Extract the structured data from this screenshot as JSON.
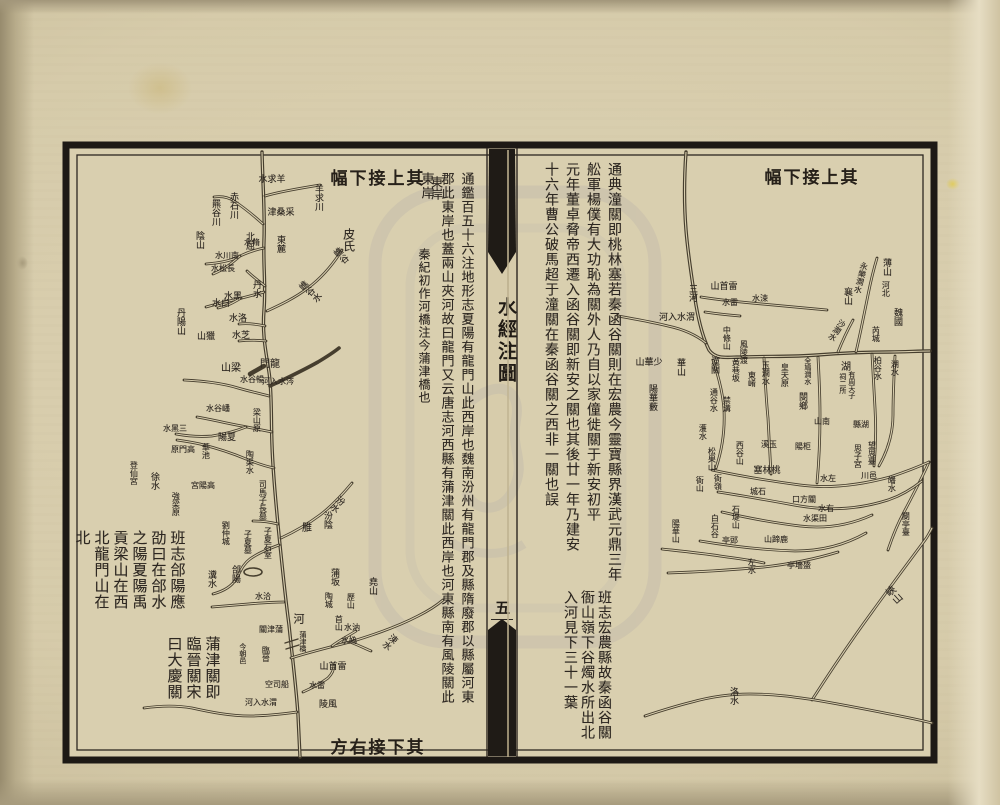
{
  "document": {
    "type": "woodblock-printed river map leaf (two-page spread)",
    "title": "水經注圖",
    "leaf_number": "五",
    "ink_color": "#2d2721",
    "paper_color": "#d9cfaf",
    "border_color": "#1d1915"
  },
  "left_map": {
    "banner_top": "其上接下幅",
    "banner_bottom": "其下接右方",
    "notes": [
      {
        "x": 466,
        "y": 172,
        "fs": 13,
        "gap": 20,
        "columns": [
          "通鑑百五十六注地形志夏陽有龍門山此西岸也魏南汾州有龍門郡及縣隋廢郡以縣屬河東",
          "郡此東岸也蓋兩山夾河故曰龍門又云唐志河西縣有蒲津關此西岸也河東縣南有風陵關此",
          "東岸"
        ]
      },
      {
        "x": 424,
        "y": 248,
        "fs": 12,
        "gap": 18,
        "columns": [
          "秦紀初作河橋注今蒲津橋也"
        ]
      },
      {
        "x": 177,
        "y": 530,
        "fs": 15,
        "gap": 19,
        "columns": [
          "班志郃陽應",
          "劭曰在郃水",
          "之陽夏陽禹",
          "貢梁山在西",
          "北龍門山在",
          "北"
        ]
      },
      {
        "x": 212,
        "y": 636,
        "fs": 15,
        "gap": 19,
        "columns": [
          "蒲津關即",
          "臨晉關宋",
          "曰大慶關"
        ]
      }
    ],
    "labels": [
      {
        "t": "羊求川",
        "x": 318,
        "y": 184,
        "o": "v",
        "s": 9
      },
      {
        "t": "羊求水",
        "x": 272,
        "y": 180,
        "o": "hr",
        "s": 9
      },
      {
        "t": "采桑津",
        "x": 281,
        "y": 213,
        "o": "hr",
        "s": 9
      },
      {
        "t": "赤石川",
        "x": 233,
        "y": 192,
        "o": "v",
        "s": 9
      },
      {
        "t": "羆谷川",
        "x": 215,
        "y": 199,
        "o": "v",
        "s": 9
      },
      {
        "t": "陰山",
        "x": 199,
        "y": 231,
        "o": "v",
        "s": 9
      },
      {
        "t": "東麓",
        "x": 280,
        "y": 235,
        "o": "v",
        "s": 9
      },
      {
        "t": "北屈",
        "x": 249,
        "y": 232,
        "o": "v",
        "s": 9
      },
      {
        "t": "脩水",
        "x": 252,
        "y": 243,
        "o": "hr",
        "s": 8
      },
      {
        "t": "南川水",
        "x": 227,
        "y": 256,
        "o": "hr",
        "s": 8
      },
      {
        "t": "長松水",
        "x": 223,
        "y": 269,
        "o": "hr",
        "s": 8
      },
      {
        "t": "丹水",
        "x": 256,
        "y": 280,
        "o": "v",
        "s": 9
      },
      {
        "t": "皮氏",
        "x": 349,
        "y": 228,
        "o": "v",
        "s": 12
      },
      {
        "t": "嶕谷",
        "x": 334,
        "y": 250,
        "o": "v",
        "s": 9,
        "r": -40
      },
      {
        "t": "嶕谷水",
        "x": 299,
        "y": 284,
        "o": "v",
        "s": 9,
        "r": -48
      },
      {
        "t": "黑水",
        "x": 233,
        "y": 297,
        "o": "hr",
        "s": 9
      },
      {
        "t": "白水",
        "x": 221,
        "y": 304,
        "o": "hr",
        "s": 9
      },
      {
        "t": "洛水",
        "x": 238,
        "y": 319,
        "o": "hr",
        "s": 9
      },
      {
        "t": "芝水",
        "x": 241,
        "y": 336,
        "o": "hr",
        "s": 9
      },
      {
        "t": "丹陽山",
        "x": 180,
        "y": 308,
        "o": "v",
        "s": 9
      },
      {
        "t": "獵山",
        "x": 206,
        "y": 337,
        "o": "hr",
        "s": 9
      },
      {
        "t": "梁山",
        "x": 231,
        "y": 369,
        "o": "hr",
        "s": 10
      },
      {
        "t": "龍門",
        "x": 270,
        "y": 365,
        "o": "hr",
        "s": 10
      },
      {
        "t": "涔水入河",
        "x": 278,
        "y": 382,
        "o": "hr",
        "s": 8
      },
      {
        "t": "暢谷水",
        "x": 252,
        "y": 380,
        "o": "hr",
        "s": 8
      },
      {
        "t": "梁山原",
        "x": 257,
        "y": 408,
        "o": "v",
        "s": 8
      },
      {
        "t": "嶓谷水",
        "x": 218,
        "y": 409,
        "o": "hr",
        "s": 8
      },
      {
        "t": "三黑水",
        "x": 175,
        "y": 429,
        "o": "hr",
        "s": 8
      },
      {
        "t": "夏陽",
        "x": 227,
        "y": 438,
        "o": "hr",
        "s": 9
      },
      {
        "t": "華池",
        "x": 206,
        "y": 443,
        "o": "v",
        "s": 8
      },
      {
        "t": "高門原",
        "x": 183,
        "y": 450,
        "o": "hr",
        "s": 8
      },
      {
        "t": "陶渠水",
        "x": 250,
        "y": 450,
        "o": "v",
        "s": 8
      },
      {
        "t": "司馬子長墓",
        "x": 263,
        "y": 480,
        "o": "v",
        "s": 8
      },
      {
        "t": "高陽宮",
        "x": 203,
        "y": 486,
        "o": "hr",
        "s": 8
      },
      {
        "t": "強梁原",
        "x": 176,
        "y": 492,
        "o": "v",
        "s": 8
      },
      {
        "t": "徐水",
        "x": 154,
        "y": 472,
        "o": "v",
        "s": 9
      },
      {
        "t": "登仙宮",
        "x": 134,
        "y": 461,
        "o": "v",
        "s": 8
      },
      {
        "t": "劉仲城",
        "x": 226,
        "y": 521,
        "o": "v",
        "s": 8
      },
      {
        "t": "子夏墓",
        "x": 248,
        "y": 530,
        "o": "v",
        "s": 8
      },
      {
        "t": "子夏石室",
        "x": 268,
        "y": 527,
        "o": "v",
        "s": 8
      },
      {
        "t": "汾水",
        "x": 342,
        "y": 496,
        "o": "v",
        "s": 9,
        "r": 38
      },
      {
        "t": "汾陰",
        "x": 327,
        "y": 511,
        "o": "v",
        "s": 9
      },
      {
        "t": "脽",
        "x": 305,
        "y": 522,
        "o": "v",
        "s": 10
      },
      {
        "t": "郃陽",
        "x": 235,
        "y": 565,
        "o": "v",
        "s": 9
      },
      {
        "t": "瀵水",
        "x": 211,
        "y": 570,
        "o": "v",
        "s": 9
      },
      {
        "t": "洽水",
        "x": 263,
        "y": 597,
        "o": "hr",
        "s": 8
      },
      {
        "t": "河",
        "x": 299,
        "y": 613,
        "o": "v",
        "s": 11
      },
      {
        "t": "蒲津關",
        "x": 271,
        "y": 630,
        "o": "hr",
        "s": 8
      },
      {
        "t": "今朝邑",
        "x": 243,
        "y": 643,
        "o": "v",
        "s": 7
      },
      {
        "t": "臨晉",
        "x": 266,
        "y": 646,
        "o": "v",
        "s": 8
      },
      {
        "t": "蒲津橋",
        "x": 303,
        "y": 631,
        "o": "v",
        "s": 7
      },
      {
        "t": "蒲坂",
        "x": 334,
        "y": 568,
        "o": "v",
        "s": 9
      },
      {
        "t": "堯山",
        "x": 372,
        "y": 577,
        "o": "v",
        "s": 9
      },
      {
        "t": "陶城",
        "x": 329,
        "y": 592,
        "o": "v",
        "s": 8
      },
      {
        "t": "歷山",
        "x": 351,
        "y": 593,
        "o": "v",
        "s": 8
      },
      {
        "t": "首山",
        "x": 339,
        "y": 615,
        "o": "v",
        "s": 8
      },
      {
        "t": "汭水",
        "x": 352,
        "y": 628,
        "o": "hr",
        "s": 8
      },
      {
        "t": "媯水",
        "x": 349,
        "y": 641,
        "o": "hr",
        "s": 8
      },
      {
        "t": "涑水",
        "x": 395,
        "y": 634,
        "o": "v",
        "s": 9,
        "r": 42
      },
      {
        "t": "雷首山",
        "x": 333,
        "y": 667,
        "o": "hr",
        "s": 9
      },
      {
        "t": "雷水",
        "x": 317,
        "y": 686,
        "o": "hr",
        "s": 8
      },
      {
        "t": "風陵",
        "x": 328,
        "y": 705,
        "o": "hr",
        "s": 9
      },
      {
        "t": "船司空",
        "x": 277,
        "y": 685,
        "o": "hr",
        "s": 8
      },
      {
        "t": "渭水入河",
        "x": 261,
        "y": 703,
        "o": "hr",
        "s": 8
      },
      {
        "t": "東岸",
        "x": 437,
        "y": 176,
        "o": "v",
        "s": 12
      }
    ]
  },
  "right_map": {
    "banner_top": "其上接下幅",
    "notes": [
      {
        "x": 614,
        "y": 162,
        "fs": 14,
        "gap": 21,
        "columns": [
          "通典潼關即桃林塞若秦函谷關則在宏農今靈寶縣界漢武元鼎三年",
          "舩軍楊僕有大功恥為關外人乃自以家僮徙關于新安初平",
          "元年董卓脅帝西遷入函谷關即新安之關也其後廿一年乃建安",
          "十六年曹公破馬超于潼關在秦函谷關之西非一關也誤"
        ]
      },
      {
        "x": 604,
        "y": 590,
        "fs": 14,
        "gap": 17,
        "columns": [
          "班志宏農縣故秦函谷關",
          "衙山嶺下谷燭水所出北",
          "入河見下三十一葉"
        ]
      }
    ],
    "labels": [
      {
        "t": "三河",
        "x": 692,
        "y": 284,
        "o": "v",
        "s": 9
      },
      {
        "t": "雷首山",
        "x": 724,
        "y": 287,
        "o": "hr",
        "s": 9
      },
      {
        "t": "雷水",
        "x": 730,
        "y": 303,
        "o": "hr",
        "s": 8
      },
      {
        "t": "涑水",
        "x": 760,
        "y": 299,
        "o": "hr",
        "s": 8
      },
      {
        "t": "渭水入河",
        "x": 677,
        "y": 318,
        "o": "hr",
        "s": 9
      },
      {
        "t": "中條山",
        "x": 727,
        "y": 326,
        "o": "v",
        "s": 8
      },
      {
        "t": "風陵渡",
        "x": 744,
        "y": 340,
        "o": "v",
        "s": 8
      },
      {
        "t": "潼關",
        "x": 714,
        "y": 356,
        "o": "v",
        "s": 9
      },
      {
        "t": "黃巷坂",
        "x": 736,
        "y": 358,
        "o": "v",
        "s": 8
      },
      {
        "t": "東崤",
        "x": 752,
        "y": 371,
        "o": "v",
        "s": 8
      },
      {
        "t": "玉澗水",
        "x": 766,
        "y": 361,
        "o": "v",
        "s": 8
      },
      {
        "t": "皇天原",
        "x": 785,
        "y": 363,
        "o": "v",
        "s": 8
      },
      {
        "t": "全鳩澗水",
        "x": 808,
        "y": 357,
        "o": "v",
        "s": 7
      },
      {
        "t": "閿鄉",
        "x": 802,
        "y": 392,
        "o": "v",
        "s": 9
      },
      {
        "t": "通谷水",
        "x": 714,
        "y": 388,
        "o": "v",
        "s": 8
      },
      {
        "t": "禁溝",
        "x": 727,
        "y": 396,
        "o": "v",
        "s": 8
      },
      {
        "t": "華山",
        "x": 680,
        "y": 358,
        "o": "v",
        "s": 9
      },
      {
        "t": "少華山",
        "x": 649,
        "y": 363,
        "o": "hr",
        "s": 9
      },
      {
        "t": "陽華藪",
        "x": 652,
        "y": 384,
        "o": "v",
        "s": 9
      },
      {
        "t": "薄山",
        "x": 886,
        "y": 258,
        "o": "v",
        "s": 9
      },
      {
        "t": "河北",
        "x": 886,
        "y": 281,
        "o": "v",
        "s": 8
      },
      {
        "t": "永樂澗水",
        "x": 865,
        "y": 262,
        "o": "v",
        "s": 8,
        "r": 14
      },
      {
        "t": "襄山",
        "x": 847,
        "y": 287,
        "o": "v",
        "s": 9
      },
      {
        "t": "魏國",
        "x": 897,
        "y": 308,
        "o": "v",
        "s": 9
      },
      {
        "t": "芮城",
        "x": 876,
        "y": 326,
        "o": "v",
        "s": 8
      },
      {
        "t": "沙澗水",
        "x": 844,
        "y": 320,
        "o": "v",
        "s": 8,
        "r": 34
      },
      {
        "t": "湖水",
        "x": 895,
        "y": 360,
        "o": "v",
        "s": 8
      },
      {
        "t": "柏谷水",
        "x": 878,
        "y": 356,
        "o": "v",
        "s": 8
      },
      {
        "t": "湖",
        "x": 844,
        "y": 361,
        "o": "v",
        "s": 10
      },
      {
        "t": "有周天子",
        "x": 852,
        "y": 371,
        "o": "v",
        "s": 7
      },
      {
        "t": "祠二所",
        "x": 843,
        "y": 373,
        "o": "v",
        "s": 7
      },
      {
        "t": "南山",
        "x": 822,
        "y": 422,
        "o": "hr",
        "s": 8
      },
      {
        "t": "湖縣",
        "x": 861,
        "y": 425,
        "o": "hr",
        "s": 8
      },
      {
        "t": "望思臺",
        "x": 872,
        "y": 441,
        "o": "v",
        "s": 8
      },
      {
        "t": "思子宮",
        "x": 858,
        "y": 444,
        "o": "v",
        "s": 8
      },
      {
        "t": "濩水",
        "x": 703,
        "y": 424,
        "o": "v",
        "s": 8
      },
      {
        "t": "松果山",
        "x": 712,
        "y": 447,
        "o": "v",
        "s": 8
      },
      {
        "t": "西谷山",
        "x": 740,
        "y": 441,
        "o": "v",
        "s": 8
      },
      {
        "t": "玉溪",
        "x": 769,
        "y": 445,
        "o": "hr",
        "s": 8
      },
      {
        "t": "柜陽",
        "x": 803,
        "y": 447,
        "o": "hr",
        "s": 8
      },
      {
        "t": "桃林塞",
        "x": 767,
        "y": 471,
        "o": "hr",
        "s": 9
      },
      {
        "t": "衙山",
        "x": 700,
        "y": 476,
        "o": "v",
        "s": 8
      },
      {
        "t": "衙嶺",
        "x": 718,
        "y": 474,
        "o": "v",
        "s": 8
      },
      {
        "t": "左水",
        "x": 828,
        "y": 479,
        "o": "hr",
        "s": 8
      },
      {
        "t": "邑川",
        "x": 869,
        "y": 476,
        "o": "hr",
        "s": 8
      },
      {
        "t": "皤水",
        "x": 892,
        "y": 476,
        "o": "v",
        "s": 8
      },
      {
        "t": "石城",
        "x": 758,
        "y": 492,
        "o": "hr",
        "s": 8
      },
      {
        "t": "關方口",
        "x": 804,
        "y": 500,
        "o": "hr",
        "s": 8
      },
      {
        "t": "右水",
        "x": 826,
        "y": 509,
        "o": "hr",
        "s": 8
      },
      {
        "t": "田渠水",
        "x": 815,
        "y": 519,
        "o": "hr",
        "s": 8
      },
      {
        "t": "白石谷",
        "x": 715,
        "y": 514,
        "o": "v",
        "s": 8
      },
      {
        "t": "石堤山",
        "x": 736,
        "y": 505,
        "o": "v",
        "s": 8
      },
      {
        "t": "郖亭",
        "x": 730,
        "y": 541,
        "o": "hr",
        "s": 8
      },
      {
        "t": "鹿蹄山",
        "x": 776,
        "y": 540,
        "o": "hr",
        "s": 8
      },
      {
        "t": "閿亭臺",
        "x": 906,
        "y": 512,
        "o": "v",
        "s": 8
      },
      {
        "t": "陽華山",
        "x": 676,
        "y": 519,
        "o": "v",
        "s": 8
      },
      {
        "t": "左水",
        "x": 752,
        "y": 558,
        "o": "v",
        "s": 8
      },
      {
        "t": "盛墻亭",
        "x": 799,
        "y": 566,
        "o": "hr",
        "s": 8
      },
      {
        "t": "峽山",
        "x": 886,
        "y": 589,
        "o": "v",
        "s": 10,
        "r": -42
      },
      {
        "t": "洛水",
        "x": 733,
        "y": 687,
        "o": "v",
        "s": 9
      }
    ]
  }
}
